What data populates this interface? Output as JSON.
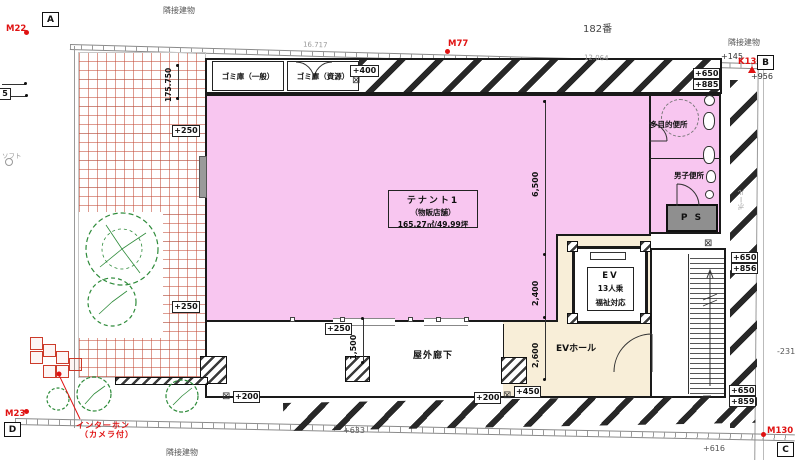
{
  "neighbors": {
    "top_left": "隣接建物",
    "top_right": "隣接建物",
    "bottom_left": "隣接建物",
    "lot_number": "182番"
  },
  "rooms": {
    "tenant_l1": "テナント1",
    "tenant_l2": "（物販店舗）",
    "tenant_l3": "165.27㎡/49.99坪",
    "garbage_general": "ゴミ庫（一般）",
    "garbage_recycle": "ゴミ庫（資源）",
    "multi_toilet": "多目的便所",
    "mens_toilet": "男子便所",
    "pipe_space": "P S",
    "ev_l1": "EV",
    "ev_l2": "13人乗",
    "ev_l3": "福祉対応",
    "ev_hall": "EVホール",
    "outdoor_corridor": "屋外廊下"
  },
  "levels": {
    "left_top": "+250",
    "left_bottom": "+250",
    "corridor_250": "+250",
    "garbage_400": "+400",
    "tr_650": "+650",
    "tr_885": "+885",
    "mr_650": "+650",
    "mr_856": "+856",
    "br_650": "+650",
    "br_859": "+859",
    "bl_200": "+200",
    "cr_200": "+200",
    "entry_450": "+450",
    "g956": "+956",
    "g145": "+145",
    "g633": "+633",
    "g616": "+616",
    "gm231": "-231",
    "g5": "5"
  },
  "dims": {
    "v175": "175.750",
    "v6500": "6,500",
    "v2400": "2,400",
    "v2600": "2,600",
    "v1500": "1,500",
    "t16717": "16.717",
    "t12064": "12.064"
  },
  "markers": {
    "m22": "M22",
    "m77": "M77",
    "k130": "K130",
    "m23": "M23",
    "m130": "M130",
    "a": "A",
    "b": "B",
    "c": "C",
    "d": "D"
  },
  "notes": {
    "intercom_l1": "インターホン",
    "intercom_l2": "（カメラ付）",
    "pole": "ポール",
    "soft": "ソフト"
  },
  "symbols": {
    "crossbox": "⊠"
  },
  "colors": {
    "tenant_pink": "#f8c6f0",
    "hall_beige": "#f8eed8",
    "marker_red": "#e01212",
    "grid_red": "#c84b37",
    "tree_green": "#2e8b3a",
    "wall_dark": "#1a1a1a",
    "ps_gray": "#8f8f8f"
  }
}
